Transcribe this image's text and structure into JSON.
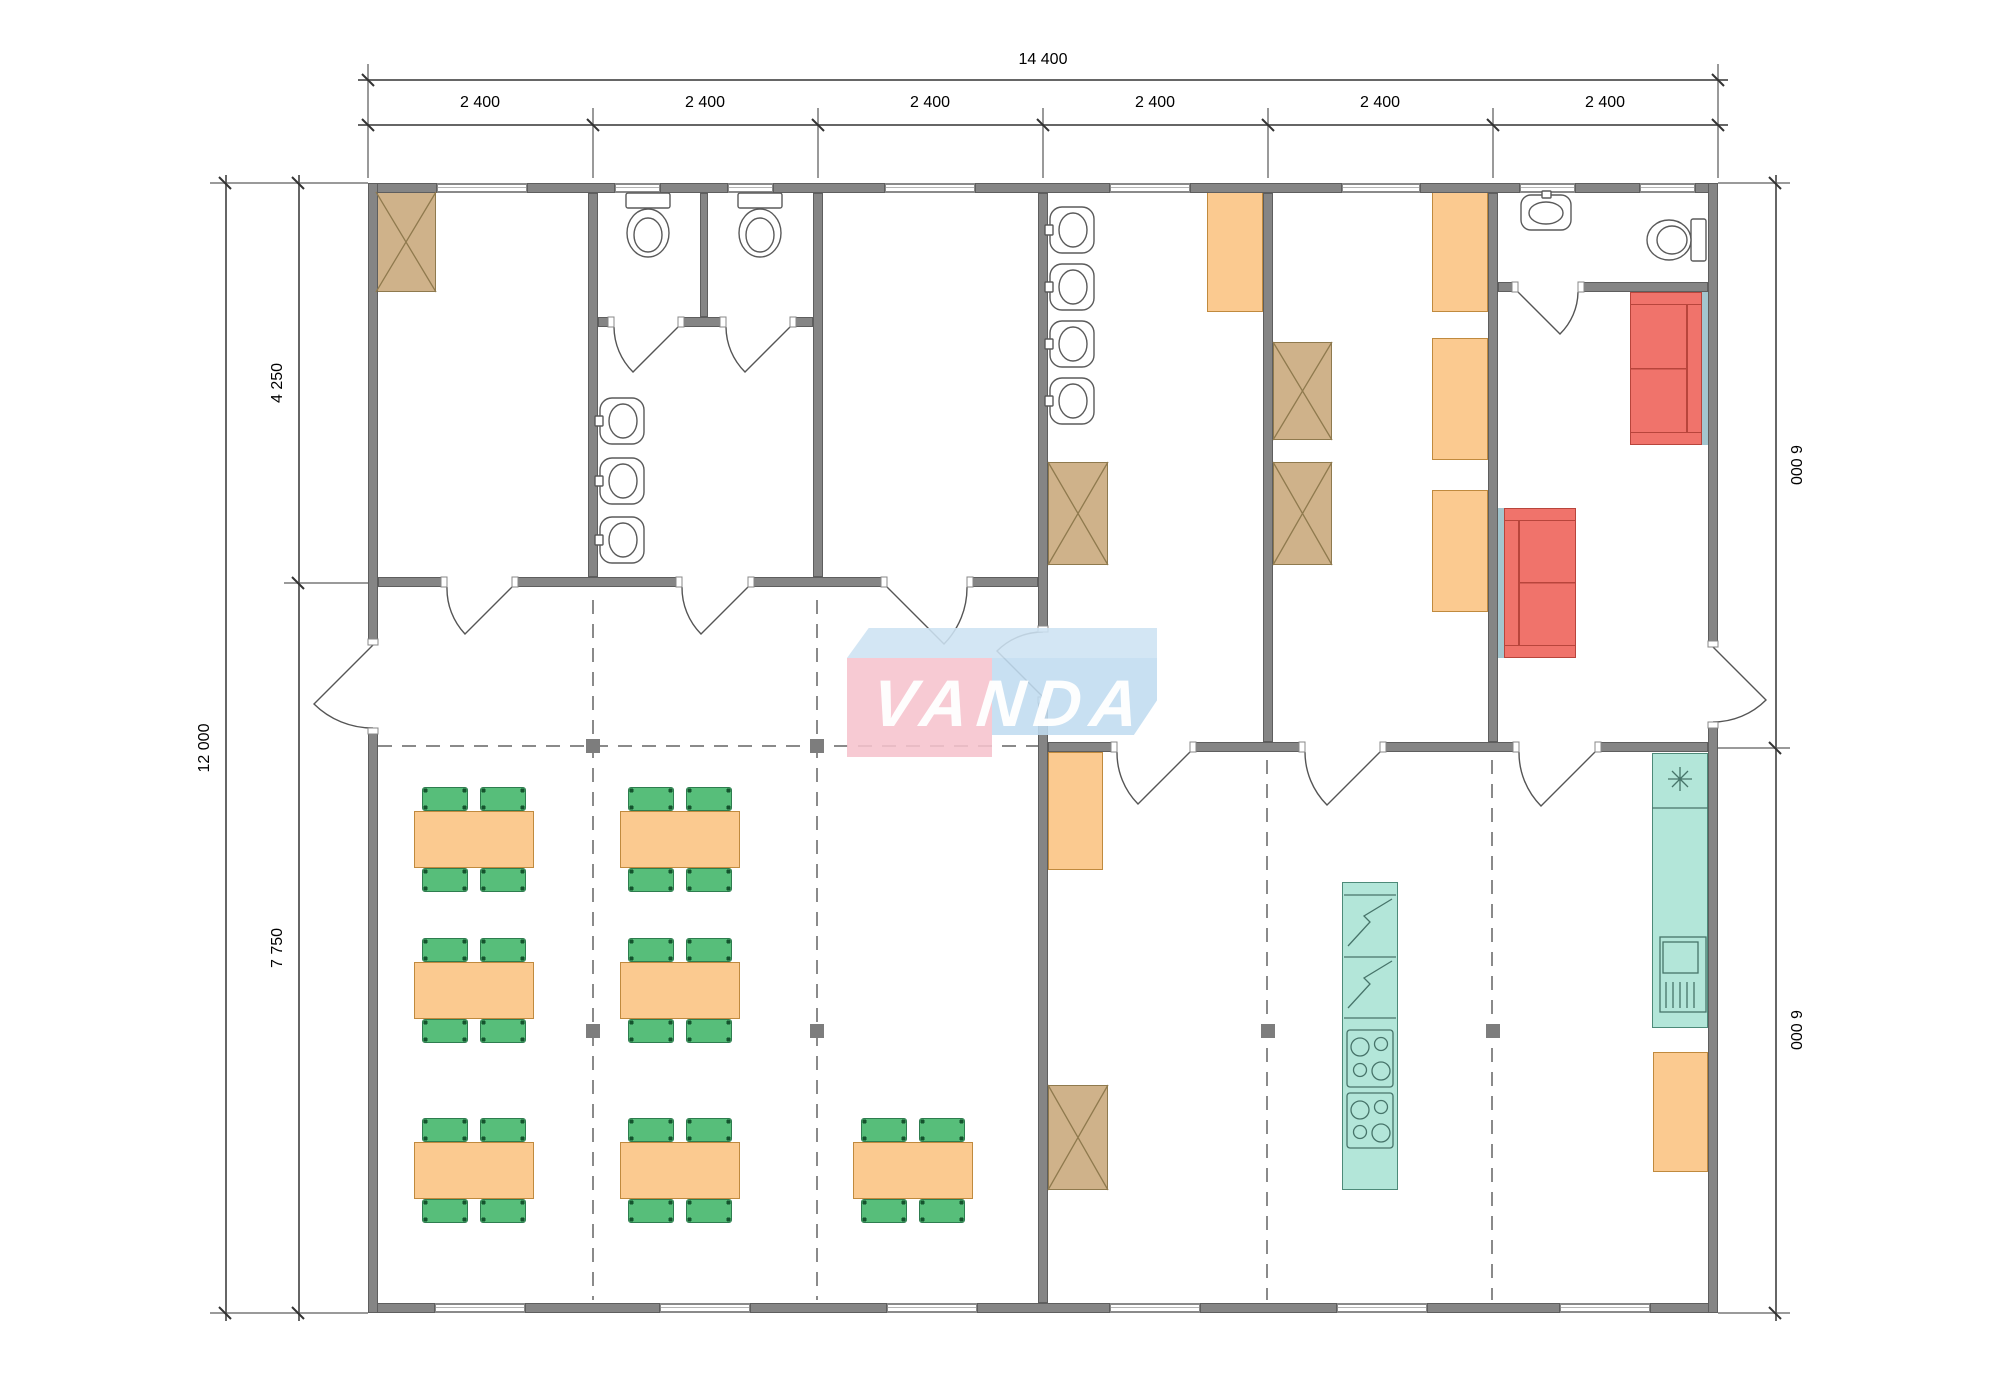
{
  "dimensions": {
    "top_total": "14 400",
    "top_modules": [
      "2 400",
      "2 400",
      "2 400",
      "2 400",
      "2 400",
      "2 400"
    ],
    "left_total": "12 000",
    "left_segments": [
      "4 250",
      "7 750"
    ],
    "right_segments": [
      "6 000",
      "6 000"
    ]
  },
  "logo": {
    "text": "VANDA"
  },
  "colors": {
    "wall": "#858585",
    "furniture_orange": "#fbca90",
    "chair_green": "#57be7a",
    "wardrobe_tan": "#cfb28a",
    "sofa_red": "#f0736b",
    "kitchen_teal": "#b3e6d9",
    "niche_teal": "#a3c6cf",
    "logo_pink": "#f6c3cd",
    "logo_blue": "#c0dcf0"
  }
}
